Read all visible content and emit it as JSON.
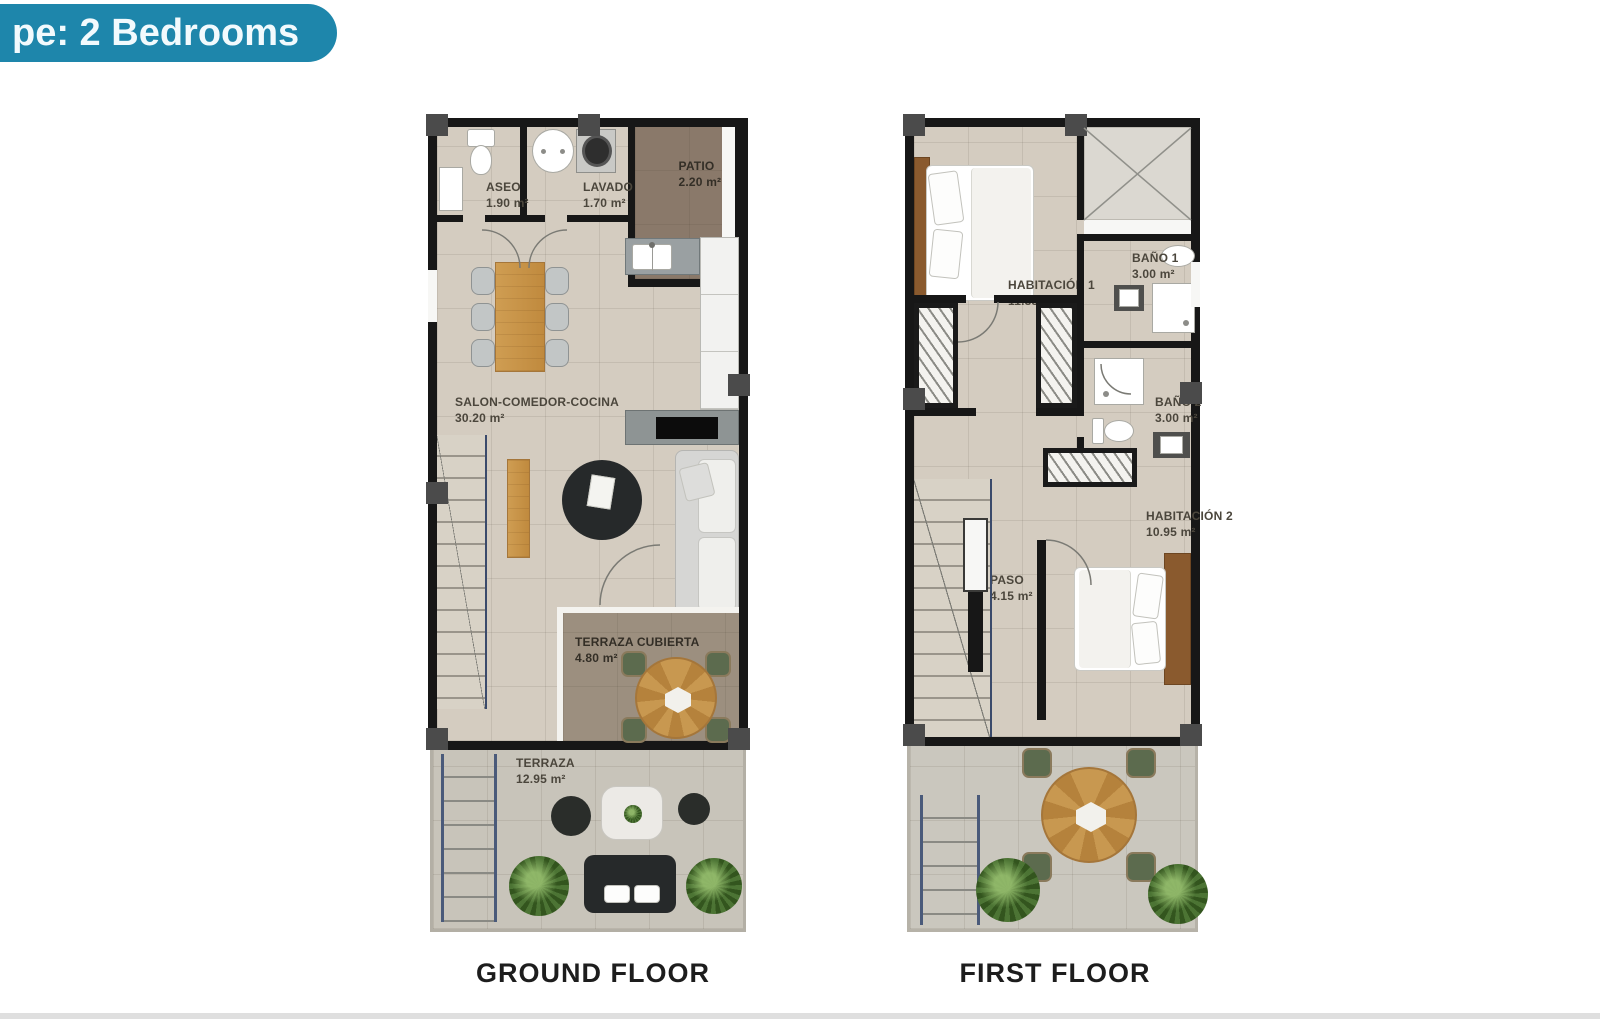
{
  "badge": {
    "label": "pe: 2 Bedrooms"
  },
  "colors": {
    "badge_bg": "#1e86ab",
    "badge_text": "#f2fafd",
    "wall": "#171717",
    "pillar": "#4b4b4b",
    "floor": "#d4ccc0",
    "patio": "#8a796a",
    "covered_terrace": "#9c8f7f",
    "terrace": "#c8c4ba",
    "label_text": "#4b463c",
    "caption_text": "#1d1d1d",
    "plant_green": "#4c7434",
    "chair_green": "#5c6b4e",
    "sofa_gray": "#d6d6d4",
    "dark_furniture": "#26292a"
  },
  "ground_floor": {
    "caption": "GROUND FLOOR",
    "rooms": [
      {
        "name": "ASEO",
        "area": "1.90 m²"
      },
      {
        "name": "LAVADO",
        "area": "1.70 m²"
      },
      {
        "name": "PATIO",
        "area": "2.20 m²"
      },
      {
        "name": "SALON-COMEDOR-COCINA",
        "area": "30.20 m²"
      },
      {
        "name": "TERRAZA CUBIERTA",
        "area": "4.80 m²"
      },
      {
        "name": "TERRAZA",
        "area": "12.95 m²"
      }
    ]
  },
  "first_floor": {
    "caption": "FIRST FLOOR",
    "rooms": [
      {
        "name": "HABITACIÓN 1",
        "area": "11.35 m²"
      },
      {
        "name": "BAÑO 1",
        "area": "3.00 m²"
      },
      {
        "name": "BAÑO 2",
        "area": "3.00 m²"
      },
      {
        "name": "HABITACIÓN 2",
        "area": "10.95 m²"
      },
      {
        "name": "PASO",
        "area": "4.15 m²"
      }
    ]
  }
}
